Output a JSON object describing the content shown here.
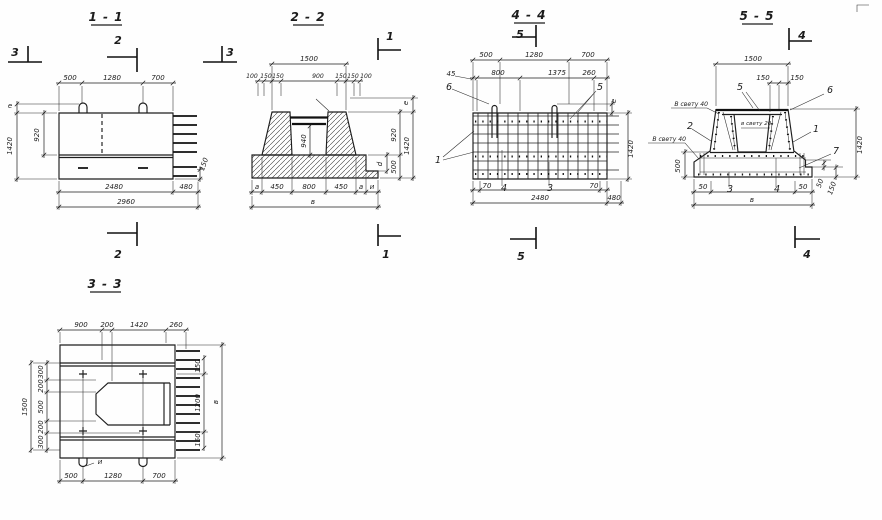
{
  "s11": {
    "title": "1 - 1",
    "marker_left": "3",
    "marker_right": "3",
    "marker_top": "2",
    "marker_bottom": "2",
    "top": [
      "500",
      "1280",
      "700"
    ],
    "left_e": "е",
    "left_h": "1420",
    "left_h2": "920",
    "right_150": "150",
    "bot_2480": "2480",
    "bot_480": "480",
    "bot_2960": "2960"
  },
  "s22": {
    "title": "2 - 2",
    "marker_top": "1",
    "marker_bottom": "1",
    "top_1500": "1500",
    "row2": [
      "100",
      "150",
      "150",
      "900",
      "150",
      "150",
      "100"
    ],
    "cavity": "940",
    "right_e": "е",
    "right_920": "920",
    "right_1420": "1420",
    "right_500": "500",
    "right_d": "d",
    "bottom": [
      "а",
      "450",
      "800",
      "450",
      "а",
      "и"
    ],
    "overall": "в"
  },
  "s33": {
    "title": "3 - 3",
    "top": [
      "900",
      "200",
      "1420",
      "260"
    ],
    "left": [
      "300",
      "200",
      "500",
      "200",
      "300"
    ],
    "left_total": "1500",
    "right": [
      "150",
      "1200",
      "150"
    ],
    "right_total": "в",
    "bottom": [
      "500",
      "1280",
      "700"
    ],
    "hook_label": "и"
  },
  "s44": {
    "title": "4 - 4",
    "marker_top": "5",
    "marker_bottom": "5",
    "top1": [
      "500",
      "1280",
      "700"
    ],
    "top2": [
      "45",
      "800",
      "1375",
      "260"
    ],
    "right_e": "е",
    "right_1420": "1420",
    "bot_70l": "70",
    "pos4": "4",
    "pos3": "3",
    "bot_70r": "70",
    "bot_2480": "2480",
    "bot_480": "480",
    "pos6": "6",
    "pos5": "5",
    "pos1": "1"
  },
  "s55": {
    "title": "5 - 5",
    "marker_top": "4",
    "marker_bottom": "4",
    "top_1500": "1500",
    "top_150a": "150",
    "top_150b": "150",
    "pos5": "5",
    "pos6": "6",
    "pos2": "2",
    "pos1": "1",
    "pos7": "7",
    "clear40a": "В свету 40",
    "clear40b": "В свету 40",
    "clear20": "в свету 20",
    "left_500": "500",
    "right_1420": "1420",
    "right_50": "50",
    "right_150": "150",
    "bot_50l": "50",
    "pos3": "3",
    "pos4": "4",
    "bot_50r": "50",
    "overall": "в"
  }
}
